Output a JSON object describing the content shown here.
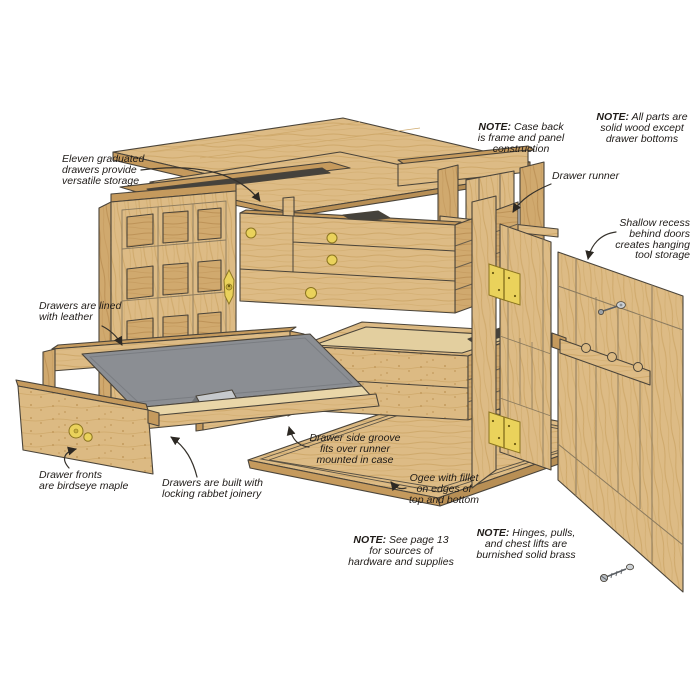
{
  "figure": {
    "description": "Exploded view illustration of an eleven-drawer maple tool chest",
    "colors": {
      "background": "#ffffff",
      "wood_light": "#ddbb85",
      "wood_mid": "#d0a96e",
      "wood_dark": "#c59a5d",
      "wood_edge": "#b88f55",
      "wood_pale": "#e9d6a8",
      "outline": "#4a443a",
      "leather_gray": "#8b8e93",
      "leather_underside": "#c6c9cc",
      "brass": "#ead25b",
      "brass_outline": "#8a7420",
      "interior_dark": "#45423c",
      "text": "#1f1b18"
    }
  },
  "labels": {
    "eleven_drawers": {
      "l1": "Eleven graduated",
      "l2": "drawers provide",
      "l3": "versatile storage"
    },
    "note_case_back": {
      "prefix": "NOTE:",
      "l1": " Case back",
      "l2": "is frame and panel",
      "l3": "construction"
    },
    "note_solid_wood": {
      "prefix": "NOTE:",
      "l1": " All parts are",
      "l2": "solid wood except",
      "l3": "drawer bottoms"
    },
    "drawer_runner": {
      "l1": "Drawer runner"
    },
    "shallow_recess": {
      "l1": "Shallow recess",
      "l2": "behind doors",
      "l3": "creates hanging",
      "l4": "tool storage"
    },
    "lined_leather": {
      "l1": "Drawers are lined",
      "l2": "with leather"
    },
    "drawer_fronts": {
      "l1": "Drawer fronts",
      "l2": "are birdseye maple"
    },
    "rabbet_joinery": {
      "l1": "Drawers are built with",
      "l2": "locking rabbet joinery"
    },
    "side_groove": {
      "l1": "Drawer side groove",
      "l2": "fits over runner",
      "l3": "mounted in case"
    },
    "ogee": {
      "l1": "Ogee with fillet",
      "l2": "on edges of",
      "l3": "top and bottom"
    },
    "note_page13": {
      "prefix": "NOTE:",
      "l1": " See page 13",
      "l2": "for sources of",
      "l3": "hardware and supplies"
    },
    "note_brass": {
      "prefix": "NOTE:",
      "l1": " Hinges, pulls,",
      "l2": "and chest lifts are",
      "l3": "burnished solid brass"
    }
  }
}
